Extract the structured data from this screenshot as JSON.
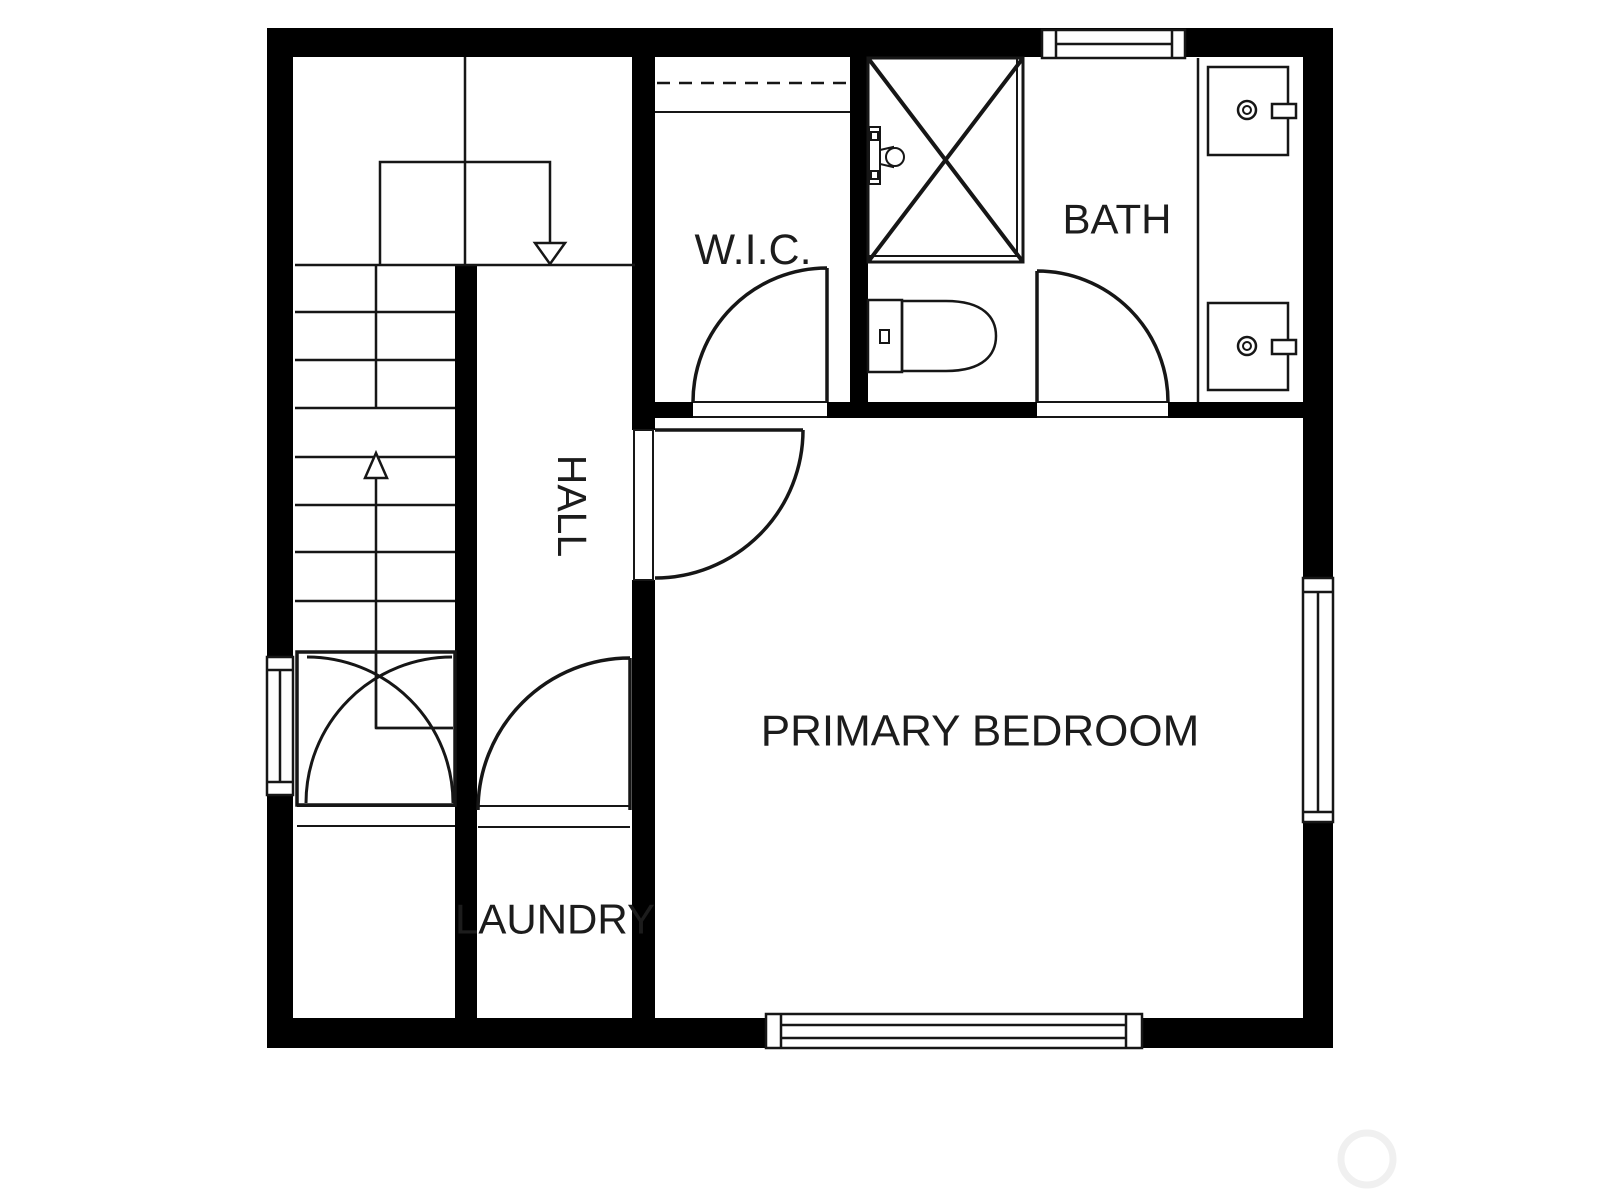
{
  "colors": {
    "background": "#ffffff",
    "wall": "#000000",
    "line": "#161616",
    "text": "#1c1c1c",
    "watermark": "#f0f0f0"
  },
  "rooms": {
    "wic": {
      "label": "W.I.C."
    },
    "bath": {
      "label": "BATH"
    },
    "hall": {
      "label": "HALL"
    },
    "primary_bedroom": {
      "label": "PRIMARY BEDROOM"
    },
    "laundry": {
      "label": "LAUNDRY"
    }
  },
  "fixtures": {
    "staircase": "staircase with up and down arrows",
    "vestibule": "double swing doors at stair base",
    "shower": "shower with cross diagonals and valve",
    "toilet": "toilet with tank and bowl",
    "vanity": "vanity counter with two sinks",
    "windows": [
      "top window",
      "left window",
      "right window",
      "bottom window"
    ],
    "doors": [
      "wic door",
      "bath door",
      "bedroom door",
      "hall door"
    ]
  }
}
